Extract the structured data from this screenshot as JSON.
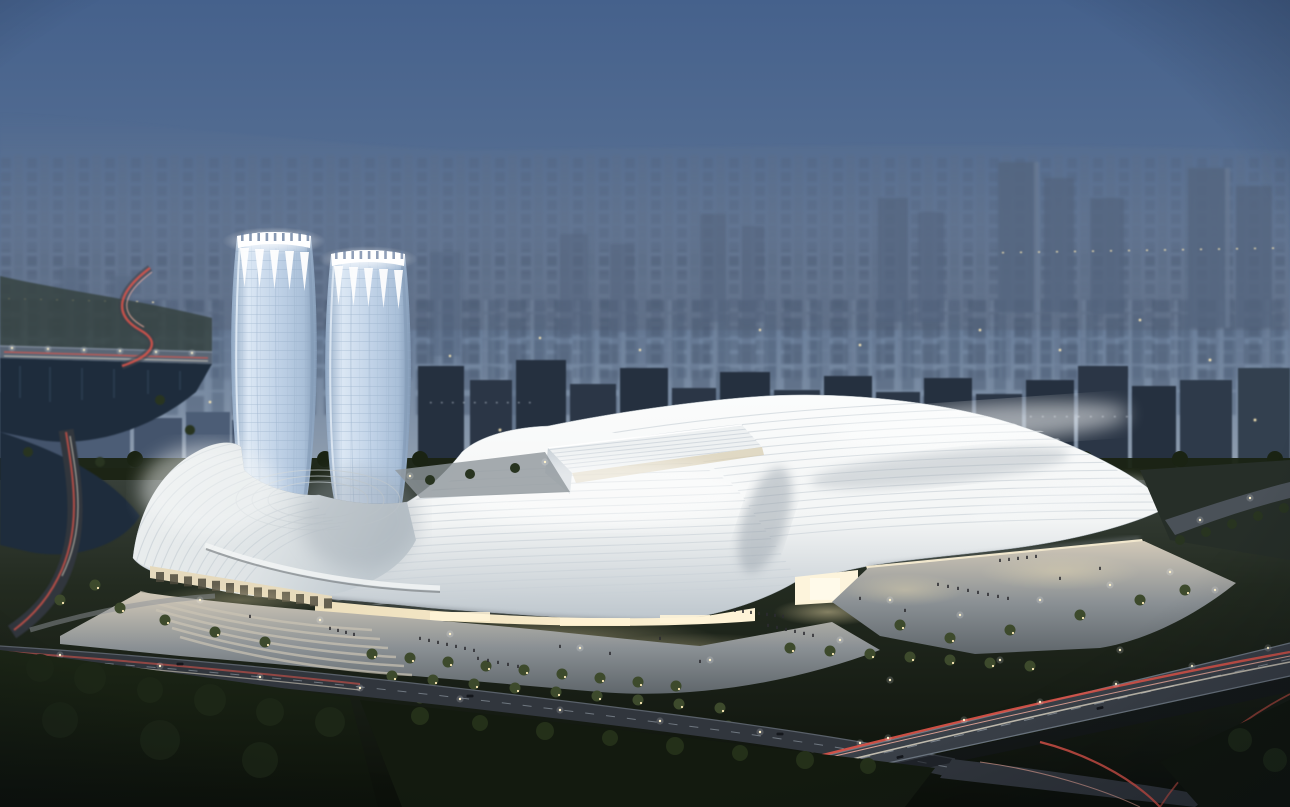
{
  "meta": {
    "title": "Dusk aerial rendering — convention & exhibition center with twin towers",
    "description": "Architectural visualization: a vast wave-roofed exhibition complex with a spiral roof wing and two illuminated-crown glass towers, set against a hazy blue city skyline at dusk, with glowing entry facades, plazas with visitors, terraced gardens, a river bridge, tree-lined boulevards and an expressway interchange with vehicle light trails.",
    "canvas": {
      "width": 1290,
      "height": 807
    }
  },
  "palette": {
    "sky": {
      "top": "#45618c",
      "mid": "#5a7294",
      "low": "#7b8da4",
      "horizon": "#95a3b3"
    },
    "city": {
      "haze": "#6d7b92",
      "far": "#53647e",
      "mid": "#4c5d76",
      "block": "#44546c",
      "dark": "#2a3545",
      "slab": "#25303f",
      "face": "#74869e",
      "treeline": "#1a2313"
    },
    "roof": {
      "bright": "#fbfcfc",
      "white": "#f3f5f5",
      "shade": "#bcc5cc",
      "deep": "#98a2ab",
      "rib": "#c9d1d7",
      "eave": "#6e757c"
    },
    "tower": {
      "light": "#dbe7f4",
      "mid": "#c0d2e7",
      "deep": "#8ea6c2",
      "grid": "#8ea6c2",
      "edge": "#7e95b2",
      "crown": "#ffffff"
    },
    "facade": {
      "warm": "#eddfbc",
      "bright": "#fff4d8",
      "glassDark": "#4e4a3c"
    },
    "plaza": {
      "lit": "#d2c9b8",
      "mid": "#8a9094",
      "dim": "#5f666b"
    },
    "road": {
      "base": "#31363d",
      "dark": "#23272e",
      "edge": "#6e7883",
      "lane": "#9aa3ad"
    },
    "nature": {
      "ground": "#232b20",
      "park": "#1c2616",
      "parkDark": "#0c110a",
      "tree": "#283420",
      "treeLit": "#3d4a2c",
      "water": "#1e2c3c",
      "bank": "#33403c"
    },
    "light": {
      "lamp": "#fff3cd",
      "window": "#cfd9e4",
      "warmWindow": "#ffecb8",
      "trailRed": "#e0554a",
      "trailHot": "#ffb4a4",
      "trailWhite": "#efe6d2"
    },
    "figure": {
      "person": "#2c2c30",
      "car": "#14171c"
    }
  },
  "scene": {
    "elements": [
      "dusk sky",
      "hazy city skyline",
      "twin glass towers with illuminated crowns",
      "wave-roofed exhibition halls",
      "spiral roof wing",
      "illuminated entry facades",
      "front plaza with visitors",
      "terraced gardens",
      "river with bridge",
      "front boulevard",
      "elevated expressway interchange",
      "tree rows",
      "vehicle light trails"
    ]
  }
}
